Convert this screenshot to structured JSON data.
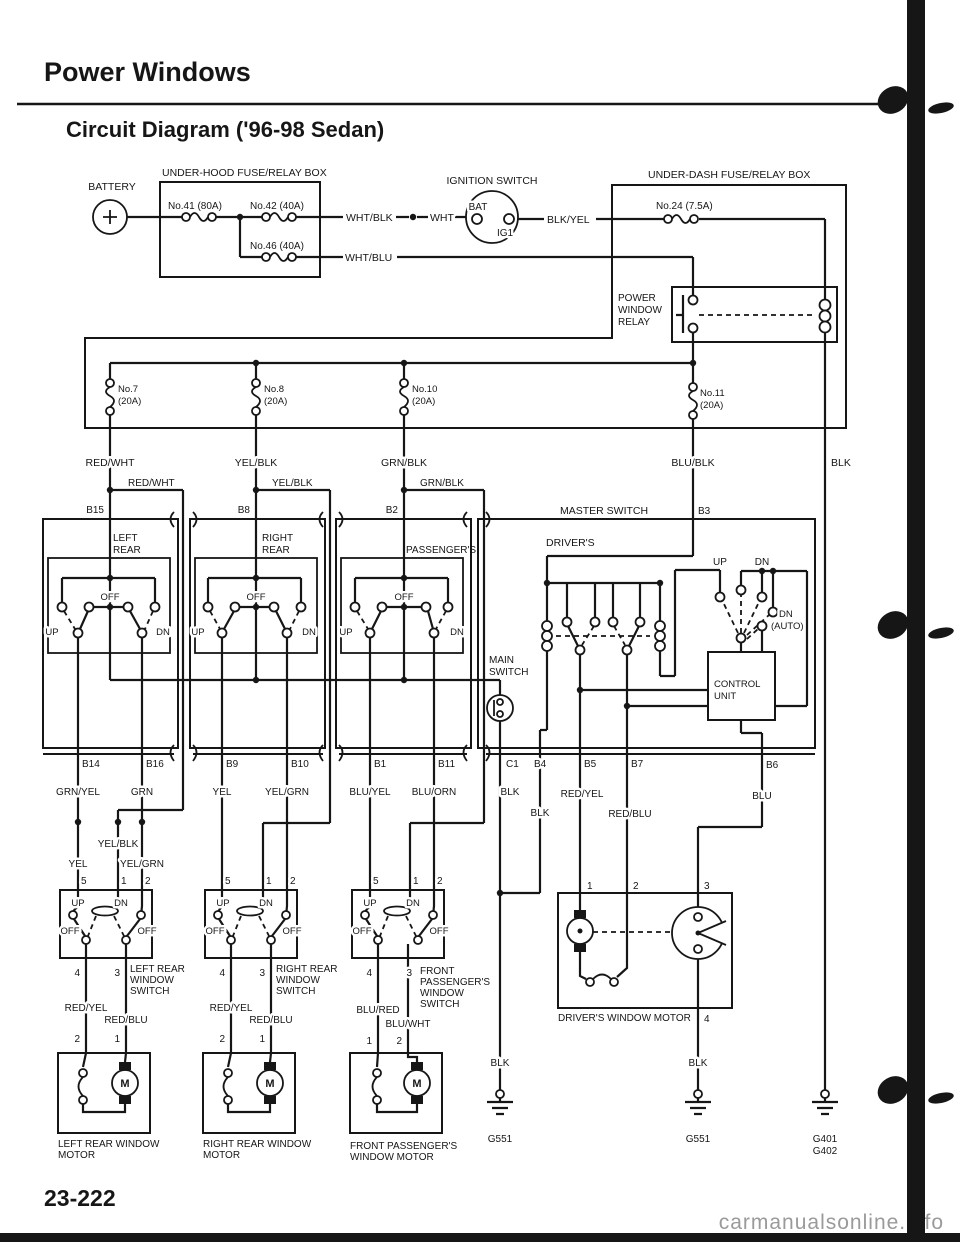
{
  "labels": {
    "title": "Power Windows",
    "subtitle": "Circuit Diagram ('96-98 Sedan)",
    "page_number": "23-222",
    "watermark": "carmanualsonline.info",
    "battery": "BATTERY",
    "underhood_box": "UNDER-HOOD FUSE/RELAY BOX",
    "fuse41": "No.41 (80A)",
    "fuse42": "No.42 (40A)",
    "fuse46": "No.46 (40A)",
    "wht_blk": "WHT/BLK",
    "wht": "WHT",
    "wht_blu": "WHT/BLU",
    "ignition_switch": "IGNITION SWITCH",
    "bat": "BAT",
    "ig1": "IG1",
    "blk_yel": "BLK/YEL",
    "underdash_box": "UNDER-DASH FUSE/RELAY BOX",
    "fuse24": "No.24 (7.5A)",
    "power": "POWER",
    "window": "WINDOW",
    "relay": "RELAY",
    "no7": "No.7",
    "no8": "No.8",
    "no10": "No.10",
    "no11": "No.11",
    "amp20": "(20A)",
    "red_wht": "RED/WHT",
    "yel_blk": "YEL/BLK",
    "grn_blk": "GRN/BLK",
    "blu_blk": "BLU/BLK",
    "blk": "BLK",
    "b15": "B15",
    "b8": "B8",
    "b2": "B2",
    "b3": "B3",
    "master_switch": "MASTER SWITCH",
    "drivers": "DRIVER'S",
    "left": "LEFT",
    "rear": "REAR",
    "right": "RIGHT",
    "passengers": "PASSENGER'S",
    "off": "OFF",
    "up": "UP",
    "dn": "DN",
    "auto": "(AUTO)",
    "main": "MAIN",
    "switch": "SWITCH",
    "control": "CONTROL",
    "unit": "UNIT",
    "b14": "B14",
    "b16": "B16",
    "b9": "B9",
    "b10": "B10",
    "b1": "B1",
    "b11": "B11",
    "c1": "C1",
    "b4": "B4",
    "b5": "B5",
    "b7": "B7",
    "b6": "B6",
    "grn_yel": "GRN/YEL",
    "grn": "GRN",
    "yel": "YEL",
    "yel_grn": "YEL/GRN",
    "blu_yel": "BLU/YEL",
    "blu_orn": "BLU/ORN",
    "red_yel": "RED/YEL",
    "red_blu": "RED/BLU",
    "blu": "BLU",
    "blu_red": "BLU/RED",
    "blu_wht": "BLU/WHT",
    "t1": "1",
    "t2": "2",
    "t3": "3",
    "t4": "4",
    "t5": "5",
    "m": "M",
    "left_rear": "LEFT REAR",
    "right_rear": "RIGHT REAR",
    "front": "FRONT",
    "motor": "MOTOR",
    "lr_motor": "LEFT REAR WINDOW",
    "rr_motor": "RIGHT REAR WINDOW",
    "fp_motor1": "FRONT PASSENGER'S",
    "fp_motor2": "WINDOW MOTOR",
    "drv_motor": "DRIVER'S WINDOW MOTOR",
    "g551": "G551",
    "g401": "G401",
    "g402": "G402"
  }
}
